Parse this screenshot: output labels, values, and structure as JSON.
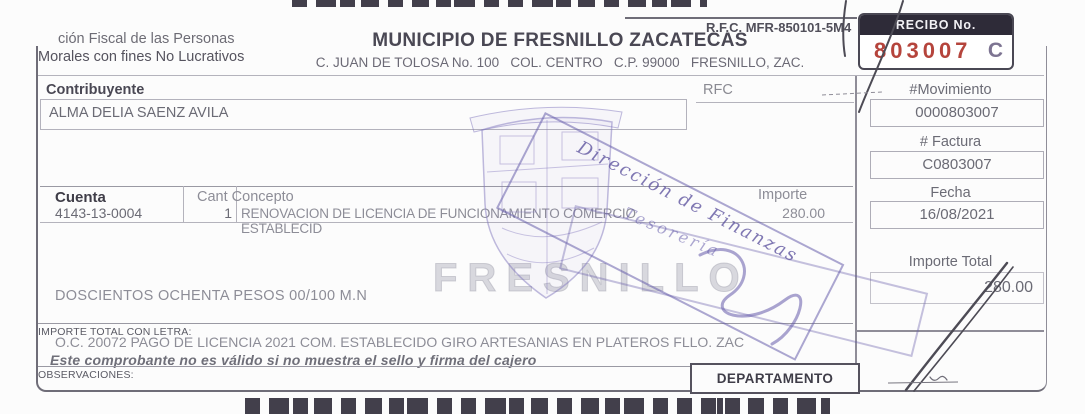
{
  "header": {
    "note_line1": "ción Fiscal de las Personas",
    "note_line2": "Morales con fines No Lucrativos",
    "title": "MUNICIPIO DE FRESNILLO ZACATECAS",
    "address": "C. JUAN DE TOLOSA No. 100   COL. CENTRO   C.P. 99000   FRESNILLO, ZAC.",
    "rfc": "R.F.C. MFR-850101-5M4",
    "recibo": {
      "label": "RECIBO No.",
      "number": "803007",
      "series": "C"
    }
  },
  "contribuyente": {
    "label": "Contribuyente",
    "value": "ALMA DELIA SAENZ AVILA"
  },
  "rfc_field": {
    "label": "RFC",
    "value": ""
  },
  "table": {
    "col_cuenta": "Cuenta",
    "col_cant_concepto": "Cant Concepto",
    "col_importe": "Importe",
    "rows": [
      {
        "cuenta": "4143-13-0004",
        "cant": "1",
        "concepto": "RENOVACION DE LICENCIA DE FUNCIONAMIENTO COMERCIO ESTABLECID",
        "importe": "280.00"
      }
    ]
  },
  "amount_words": "DOSCIENTOS OCHENTA PESOS 00/100 M.N",
  "footer": {
    "importe_letra_label": "IMPORTE TOTAL CON LETRA:",
    "oc_line": "O.C. 20072 PAGO DE LICENCIA 2021 COM. ESTABLECIDO GIRO ARTESANIAS EN PLATEROS FLLO. ZAC",
    "validity": "Este comprobante no es válido si no muestra el sello y firma del cajero",
    "observaciones_label": "OBSERVACIONES:",
    "departamento_label": "DEPARTAMENTO"
  },
  "side": {
    "movimiento_label": "#Movimiento",
    "movimiento": "0000803007",
    "factura_label": "# Factura",
    "factura": "C0803007",
    "fecha_label": "Fecha",
    "fecha": "16/08/2021",
    "importe_total_label": "Importe Total",
    "importe_total": "280.00"
  },
  "stamp": {
    "line1": "Dirección de Finanzas",
    "line2": "Tesorería",
    "watermark": "FRESNILLO"
  },
  "colors": {
    "recibo_number_red": "#b5443c",
    "recibo_header_bg": "#2e2b38",
    "series_purple": "#7d7492",
    "stamp_purple": "#685eac",
    "watermark_gray": "#babac5",
    "ink_gray": "#4a4854"
  }
}
